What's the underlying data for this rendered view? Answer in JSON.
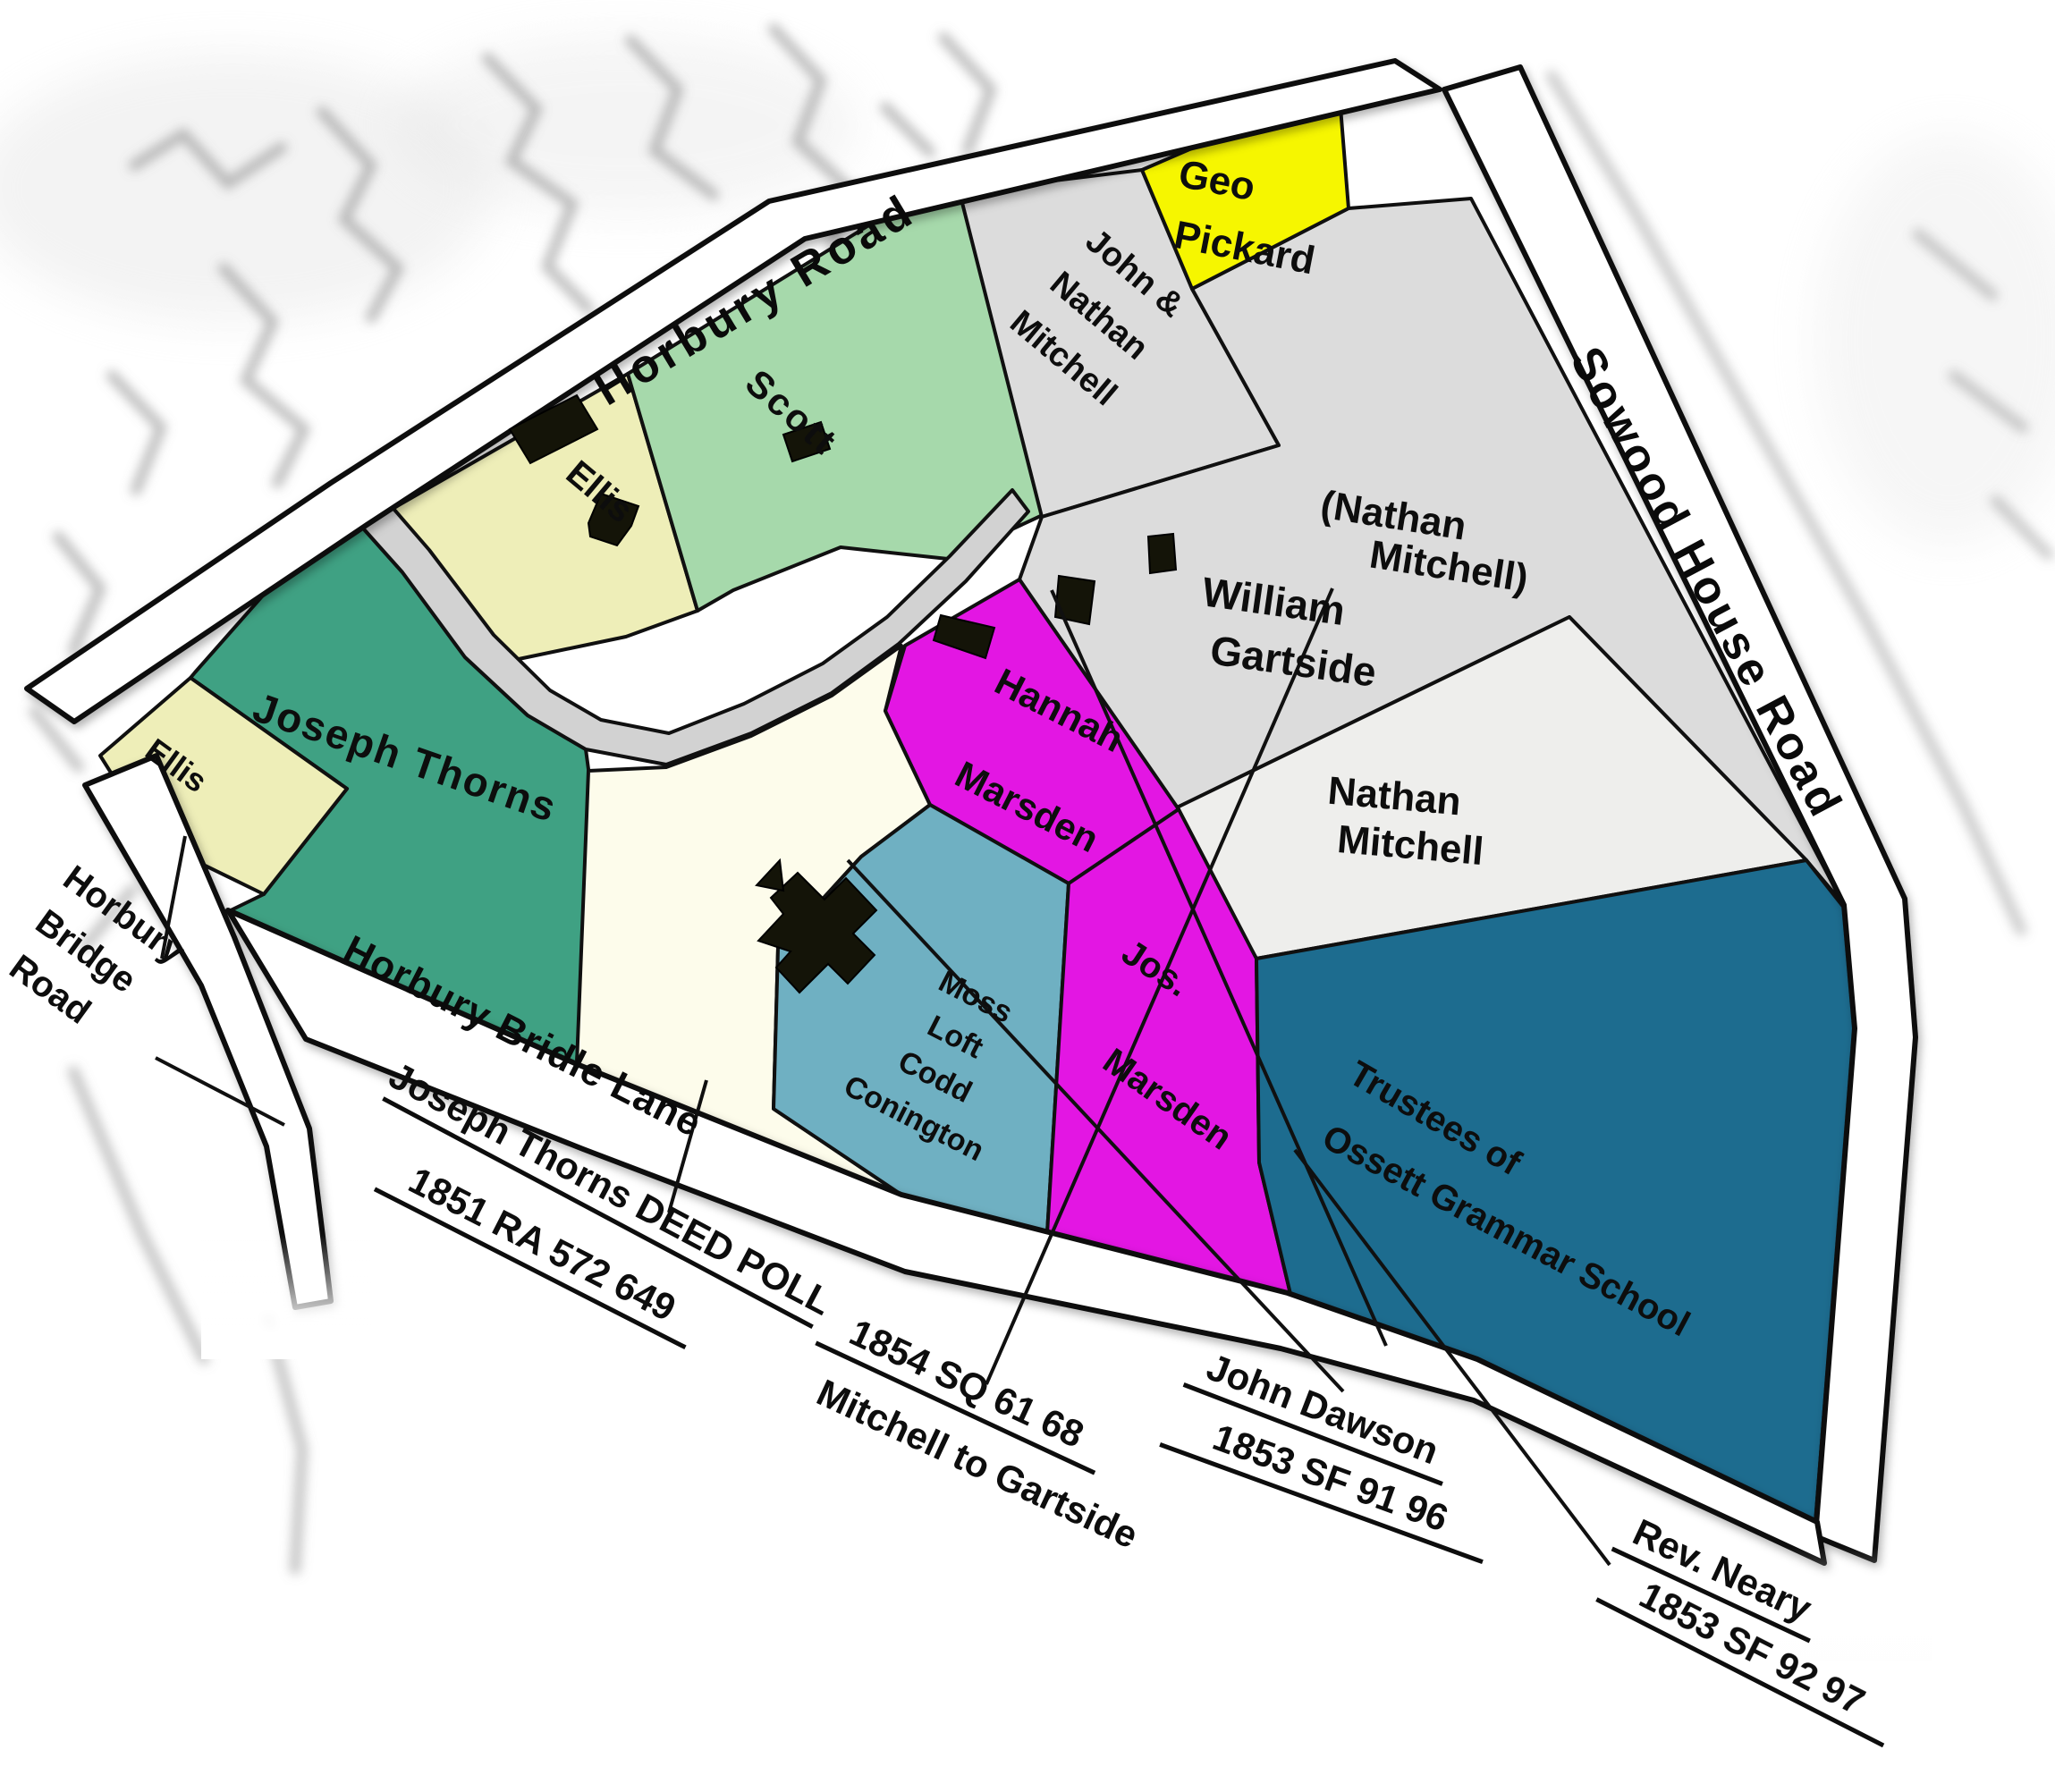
{
  "roads": {
    "horbury_road": {
      "label": "Horbury Road"
    },
    "sowood_house_road": {
      "label": "Sowood House Road"
    },
    "horbury_bridge_road": {
      "lines": [
        "Horbury",
        "Bridge",
        "Road"
      ]
    },
    "horbury_bridle_lane": {
      "label": "Horbury Bridle Lane"
    }
  },
  "plots": {
    "ellis_west": {
      "owner": "Ellis",
      "color": "#eeeeb8"
    },
    "ellis_north": {
      "owner": "Ellis",
      "color": "#eeeeb8"
    },
    "joseph_thorns": {
      "owner": "Joseph Thorns",
      "color": "#3fa183"
    },
    "central_homestead": {
      "color": "#fdfceb"
    },
    "scott": {
      "owner": "Scott",
      "color": "#a6d9ab"
    },
    "john_nathan_mitchell": {
      "owner": "John & Nathan Mitchell",
      "lines": [
        "John &",
        "Nathan",
        "Mitchell"
      ],
      "color": "#dcdcdc"
    },
    "geo_pickard": {
      "owner": "Geo Pickard",
      "lines": [
        "Geo",
        "Pickard"
      ],
      "color": "#f6f600"
    },
    "william_gartside": {
      "owner": "William Gartside",
      "lines": [
        "William",
        "Gartside"
      ],
      "former_owner_note": "(Nathan Mitchell)",
      "former_lines": [
        "(Nathan",
        "Mitchell)"
      ],
      "note_color": "#8a8a64",
      "color": "#dcdcdc"
    },
    "nathan_mitchell": {
      "owner": "Nathan Mitchell",
      "lines": [
        "Nathan",
        "Mitchell"
      ],
      "color": "#eeeeec"
    },
    "hannah_marsden": {
      "owner": "Hannah Marsden",
      "lines": [
        "Hannah",
        "Marsden"
      ],
      "color": "#e316e3"
    },
    "jos_marsden": {
      "owner": "Jos. Marsden",
      "lines": [
        "Jos.",
        "Marsden"
      ],
      "color": "#e316e3"
    },
    "moss_loft_codd_conington": {
      "owner": "Moss Loft Codd Conington",
      "lines": [
        "Moss",
        "Loft",
        "Codd",
        "Conington"
      ],
      "color": "#6fb0c2"
    },
    "trustees_ossett_grammar": {
      "owner": "Trustees of Ossett Grammar School",
      "lines": [
        "Trustees of",
        "Ossett Grammar School"
      ],
      "color": "#1d6c8f"
    }
  },
  "deeds": {
    "thorns_deed_poll": {
      "lines": [
        "Joseph Thorns DEED POLL",
        "1851 RA  572  649"
      ]
    },
    "mitchell_to_gartside": {
      "lines": [
        "1854 SQ  61  68",
        "Mitchell to Gartside"
      ],
      "line_color": "#8a8a64"
    },
    "john_dawson": {
      "lines": [
        "John Dawson",
        "1853  SF  91  96"
      ]
    },
    "rev_neary": {
      "lines": [
        "Rev. Neary",
        "1853  SF  92  97"
      ]
    }
  },
  "road_surface_color": "#ffffff",
  "inner_lane_color": "#d2d2d2"
}
